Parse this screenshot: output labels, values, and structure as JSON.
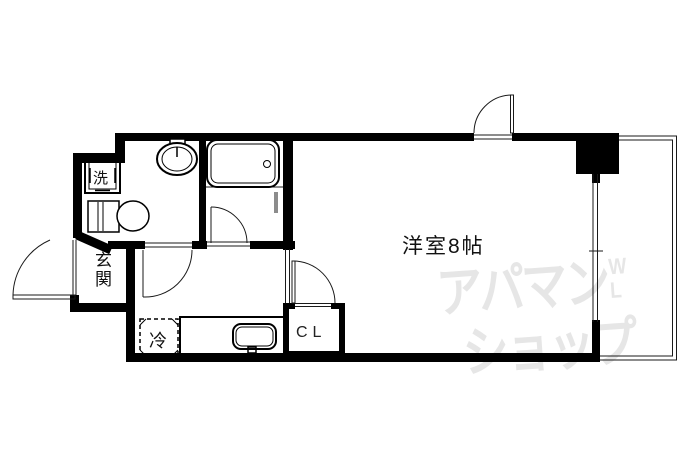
{
  "floorplan": {
    "labels": {
      "main_room": "洋室8帖",
      "entrance": "玄関",
      "washer": "洗",
      "fridge": "冷",
      "closet": "CL"
    },
    "watermark": {
      "line1": "アパマン",
      "line2": "ショップ",
      "mark_top": "W",
      "mark_bottom": "L",
      "color": "#e6e6e6"
    },
    "colors": {
      "wall": "#000000",
      "thin_line": "#1a1a1a",
      "background": "#ffffff"
    }
  }
}
